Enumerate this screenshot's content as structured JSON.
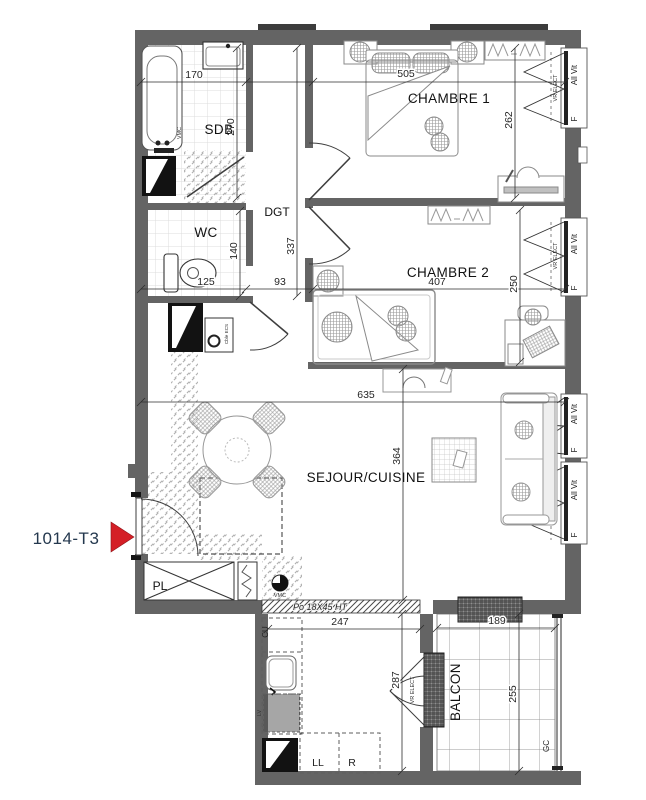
{
  "plan": {
    "unit_label": "1014-T3",
    "rooms": {
      "sdb": "SDB",
      "wc": "WC",
      "dgt": "DGT",
      "chambre1": "CHAMBRE 1",
      "chambre2": "CHAMBRE 2",
      "sejour": "SEJOUR/CUISINE",
      "pl": "PL",
      "balcon": "BALCON"
    },
    "dims": {
      "sdb_w": "170",
      "sdb_d": "270",
      "wc_w": "125",
      "wc_d": "140",
      "dgt_w": "93",
      "dgt_d": "337",
      "ch1_w": "505",
      "ch1_d": "262",
      "ch2_w": "407",
      "ch2_d": "250",
      "sej_w": "635",
      "sej_d": "364",
      "cu_w": "247",
      "cu_d": "287",
      "bal_w": "189",
      "bal_d": "255"
    },
    "annotations": {
      "beam": "Po 18X45 HT",
      "cu": "CU",
      "lv": "LV",
      "ll": "LL",
      "fridge": "R",
      "vmc": "VMC",
      "gc": "GC",
      "ecs": "Cble ECS"
    },
    "windows": {
      "shutter": "VR ELECT",
      "glazing": "All Vit",
      "fixed": "F"
    },
    "colors": {
      "wall": "#646464",
      "marker": "#d41f26"
    }
  }
}
